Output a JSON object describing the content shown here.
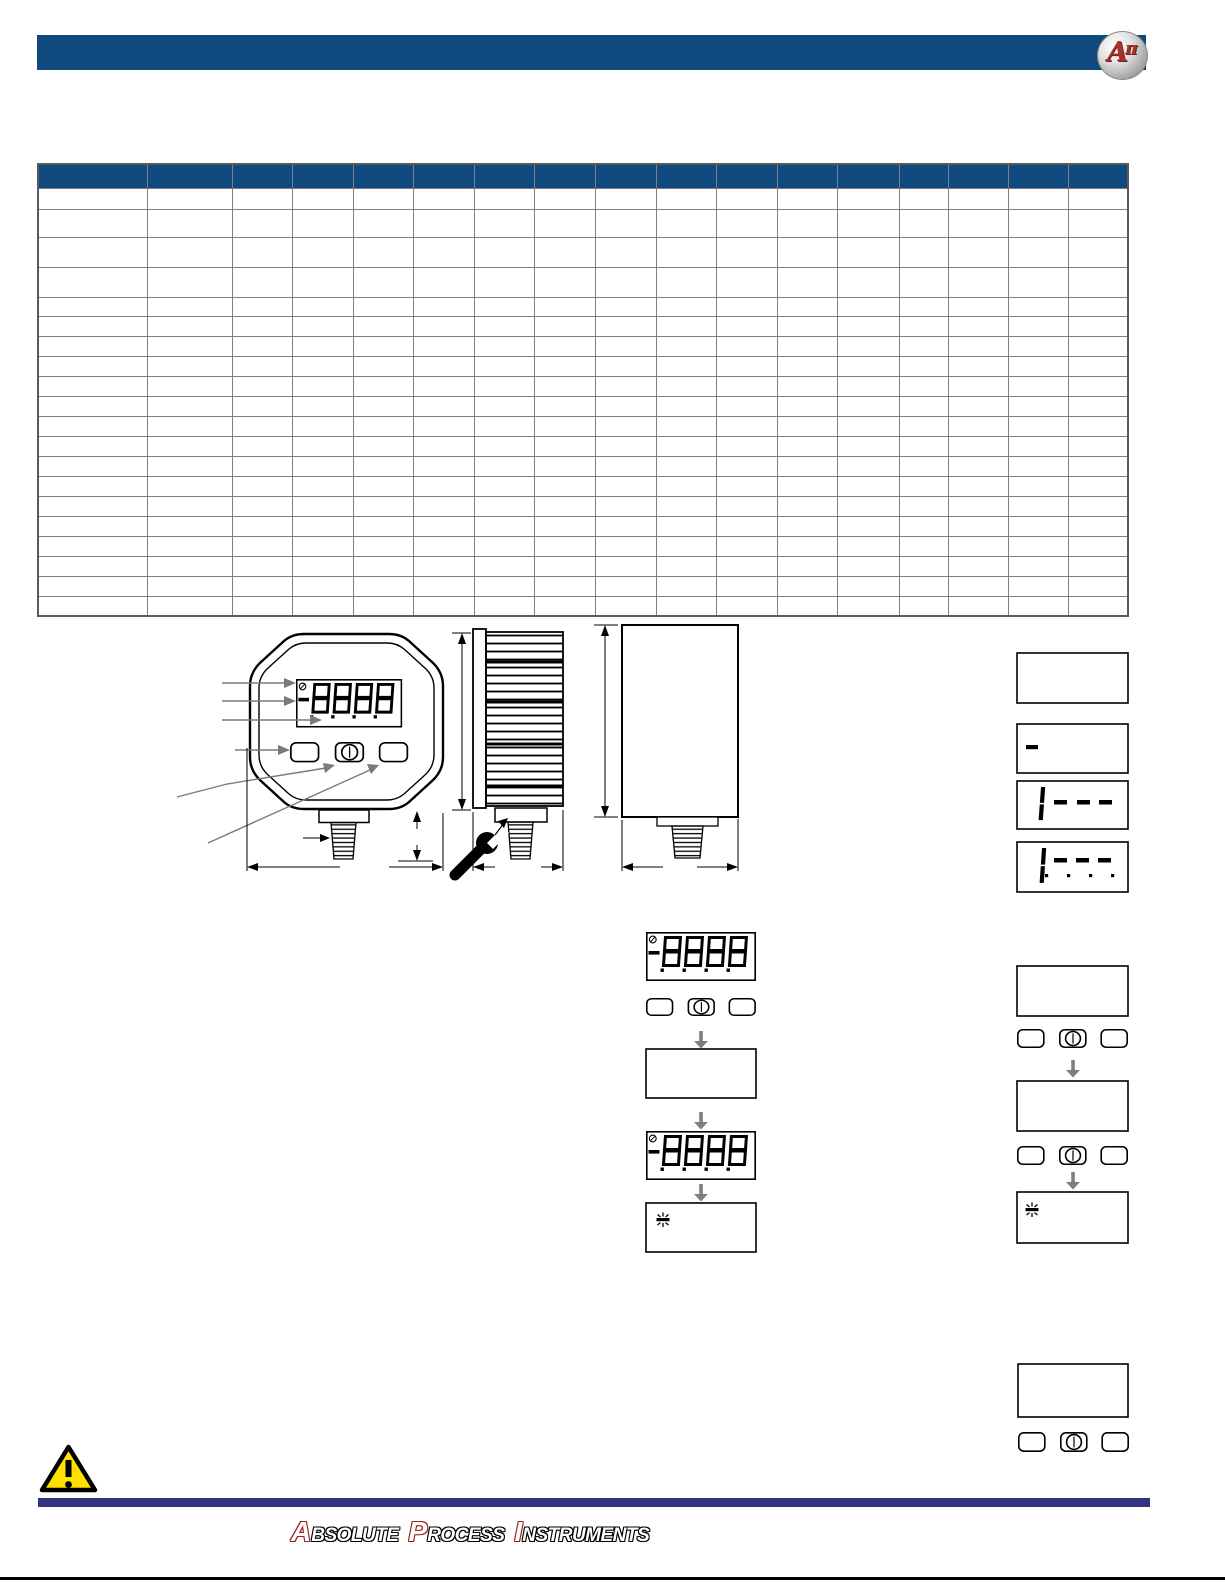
{
  "header": {
    "bar_color": "#10497E",
    "logo": {
      "letter_a": "A",
      "letter_pi": "π",
      "letter_color": "#A8322A",
      "shape": "silver-oval"
    }
  },
  "spec_table": {
    "type": "table",
    "columns": 17,
    "rows": 20,
    "all_cells_empty": true,
    "header_fill": "#10497E",
    "border_color": "#7F7F7F",
    "col_widths_px": [
      109,
      85,
      60,
      61,
      60,
      61,
      60,
      61,
      61,
      60,
      61,
      60,
      62,
      49,
      60,
      60,
      60
    ],
    "header_height_px": 24,
    "row_heights_px": [
      21,
      28,
      30,
      30,
      19,
      20,
      20,
      20,
      20,
      20,
      20,
      20,
      20,
      20,
      20,
      20,
      20,
      20,
      20,
      20
    ]
  },
  "diagram": {
    "views": [
      "front",
      "side",
      "back"
    ],
    "lcd_digits": "8888",
    "lcd_minus": "-",
    "lcd_battery_icon": "low-battery",
    "buttons": [
      "left-button",
      "power-button",
      "right-button"
    ],
    "power_glyph": "circle-with-bar",
    "wrench_icon": "wrench",
    "callout_count": 6,
    "dimension_lines": "height, width, port-height"
  },
  "display_samples": [
    {
      "value": ""
    },
    {
      "value": "-"
    },
    {
      "value": "1---"
    },
    {
      "value": "1-.-.-."
    }
  ],
  "flows": {
    "middle": [
      "display-8888",
      "button-row",
      "down-arrow",
      "blank-display",
      "down-arrow",
      "display-8888",
      "down-arrow",
      "blinking-indicator"
    ],
    "right": [
      "blank-display",
      "button-row",
      "down-arrow",
      "blank-display",
      "button-row",
      "down-arrow",
      "blinking-indicator"
    ],
    "bottom_right": [
      "blank-display",
      "button-row"
    ]
  },
  "warning": {
    "glyph": "!",
    "fill": "#FFE000",
    "border": "#000000"
  },
  "footer": {
    "bar_color": "#32327E",
    "words": [
      {
        "initial": "A",
        "rest": "bsolute"
      },
      {
        "initial": "P",
        "rest": "rocess"
      },
      {
        "initial": "I",
        "rest": "nstruments"
      }
    ]
  }
}
